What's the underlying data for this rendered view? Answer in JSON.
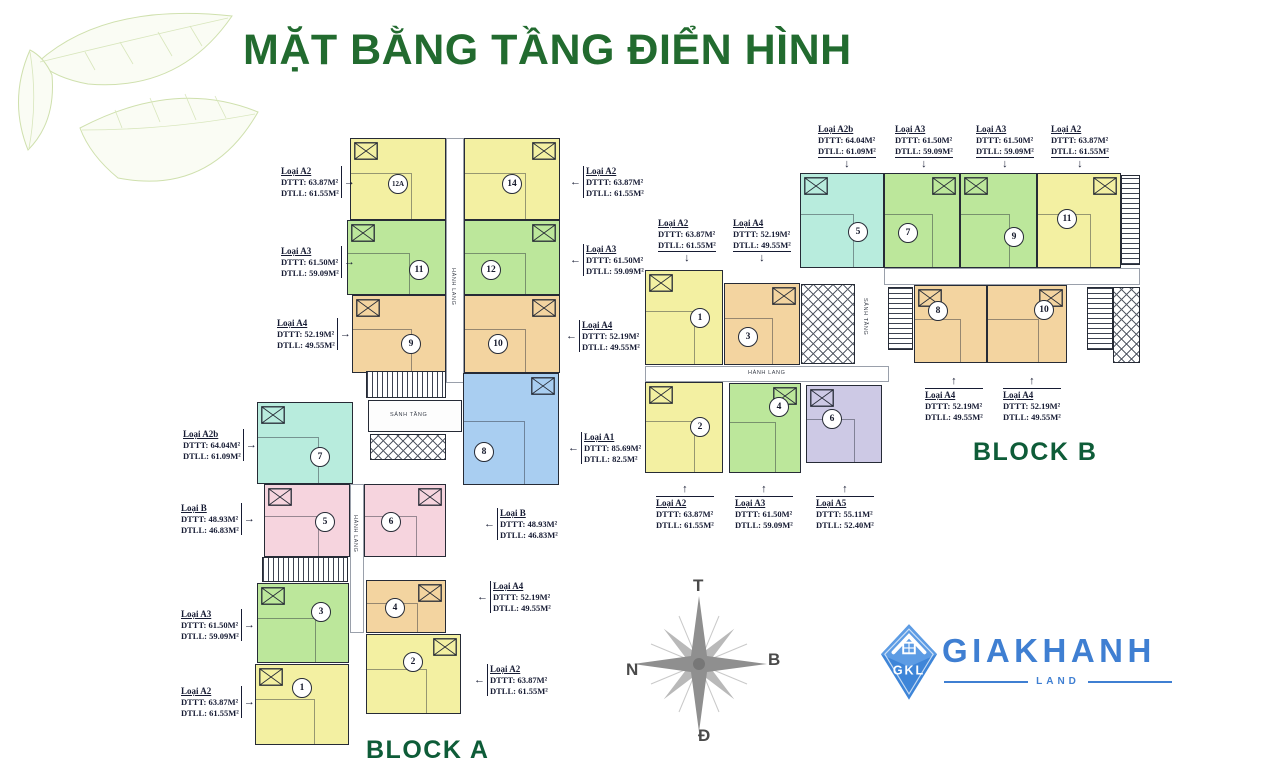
{
  "title": "MẶT BẰNG TẦNG ĐIỂN HÌNH",
  "block_a_label": "BLOCK A",
  "block_b_label": "BLOCK B",
  "compass": {
    "top": "T",
    "right": "B",
    "bottom": "Đ",
    "left": "N"
  },
  "logo": {
    "badge": "GKL",
    "brand": "GIAKHANH",
    "sub": "LAND"
  },
  "colors": {
    "title_green": "#226b2f",
    "block_green": "#0e5c38",
    "wall": "#262b36",
    "label_ink": "#161b33",
    "logo_blue": "#3f7fd2",
    "leaf_green": "#cfe0ad",
    "compass_gray": "#8f8f8f",
    "units": {
      "yellow": "#f3f0a2",
      "green": "#bce79b",
      "orange": "#f3d4a0",
      "teal": "#b8ecdd",
      "blue": "#a9cef1",
      "pink": "#f6d4de",
      "purple": "#cdc9e5"
    }
  },
  "units": [
    {
      "block": "A",
      "no": "12A",
      "color": "yellow",
      "x": 350,
      "y": 138,
      "w": 96,
      "h": 82,
      "cx": 398,
      "cy": 184
    },
    {
      "block": "A",
      "no": "14",
      "color": "yellow",
      "x": 464,
      "y": 138,
      "w": 96,
      "h": 82,
      "cx": 512,
      "cy": 184
    },
    {
      "block": "A",
      "no": "11",
      "color": "green",
      "x": 347,
      "y": 220,
      "w": 99,
      "h": 75,
      "cx": 419,
      "cy": 270
    },
    {
      "block": "A",
      "no": "12",
      "color": "green",
      "x": 464,
      "y": 220,
      "w": 96,
      "h": 75,
      "cx": 491,
      "cy": 270
    },
    {
      "block": "A",
      "no": "9",
      "color": "orange",
      "x": 352,
      "y": 295,
      "w": 94,
      "h": 78,
      "cx": 411,
      "cy": 344
    },
    {
      "block": "A",
      "no": "10",
      "color": "orange",
      "x": 464,
      "y": 295,
      "w": 96,
      "h": 78,
      "cx": 498,
      "cy": 344
    },
    {
      "block": "A",
      "no": "7",
      "color": "teal",
      "x": 257,
      "y": 402,
      "w": 96,
      "h": 82,
      "cx": 320,
      "cy": 457
    },
    {
      "block": "A",
      "no": "8",
      "color": "blue",
      "x": 463,
      "y": 373,
      "w": 96,
      "h": 112,
      "cx": 484,
      "cy": 452
    },
    {
      "block": "A",
      "no": "5",
      "color": "pink",
      "x": 264,
      "y": 484,
      "w": 86,
      "h": 73,
      "cx": 325,
      "cy": 522
    },
    {
      "block": "A",
      "no": "6",
      "color": "pink",
      "x": 364,
      "y": 484,
      "w": 82,
      "h": 73,
      "cx": 391,
      "cy": 522
    },
    {
      "block": "A",
      "no": "3",
      "color": "green",
      "x": 257,
      "y": 583,
      "w": 92,
      "h": 80,
      "cx": 321,
      "cy": 612
    },
    {
      "block": "A",
      "no": "4",
      "color": "orange",
      "x": 366,
      "y": 580,
      "w": 80,
      "h": 53,
      "cx": 395,
      "cy": 608
    },
    {
      "block": "A",
      "no": "1",
      "color": "yellow",
      "x": 255,
      "y": 664,
      "w": 94,
      "h": 81,
      "cx": 302,
      "cy": 688
    },
    {
      "block": "A",
      "no": "2",
      "color": "yellow",
      "x": 366,
      "y": 634,
      "w": 95,
      "h": 80,
      "cx": 413,
      "cy": 662
    },
    {
      "block": "B",
      "no": "5",
      "color": "teal",
      "x": 800,
      "y": 173,
      "w": 84,
      "h": 95,
      "cx": 858,
      "cy": 232
    },
    {
      "block": "B",
      "no": "7",
      "color": "green",
      "x": 884,
      "y": 173,
      "w": 76,
      "h": 95,
      "cx": 908,
      "cy": 233
    },
    {
      "block": "B",
      "no": "9",
      "color": "green",
      "x": 960,
      "y": 173,
      "w": 77,
      "h": 95,
      "cx": 1014,
      "cy": 237
    },
    {
      "block": "B",
      "no": "11",
      "color": "yellow",
      "x": 1037,
      "y": 173,
      "w": 84,
      "h": 95,
      "cx": 1067,
      "cy": 219
    },
    {
      "block": "B",
      "no": "1",
      "color": "yellow",
      "x": 645,
      "y": 270,
      "w": 78,
      "h": 95,
      "cx": 700,
      "cy": 318
    },
    {
      "block": "B",
      "no": "3",
      "color": "orange",
      "x": 724,
      "y": 283,
      "w": 76,
      "h": 82,
      "cx": 748,
      "cy": 337
    },
    {
      "block": "B",
      "no": "8",
      "color": "orange",
      "x": 914,
      "y": 285,
      "w": 73,
      "h": 78,
      "cx": 938,
      "cy": 311
    },
    {
      "block": "B",
      "no": "10",
      "color": "orange",
      "x": 987,
      "y": 285,
      "w": 80,
      "h": 78,
      "cx": 1044,
      "cy": 310
    },
    {
      "block": "B",
      "no": "2",
      "color": "yellow",
      "x": 645,
      "y": 382,
      "w": 78,
      "h": 91,
      "cx": 700,
      "cy": 427
    },
    {
      "block": "B",
      "no": "4",
      "color": "green",
      "x": 729,
      "y": 383,
      "w": 72,
      "h": 90,
      "cx": 779,
      "cy": 407
    },
    {
      "block": "B",
      "no": "6",
      "color": "purple",
      "x": 806,
      "y": 385,
      "w": 76,
      "h": 78,
      "cx": 832,
      "cy": 419
    }
  ],
  "cores": [
    {
      "kind": "corridor",
      "x": 446,
      "y": 138,
      "w": 18,
      "h": 245
    },
    {
      "kind": "corridor",
      "x": 350,
      "y": 484,
      "w": 14,
      "h": 149
    },
    {
      "kind": "stair",
      "x": 366,
      "y": 371,
      "w": 80,
      "h": 27
    },
    {
      "kind": "lobby",
      "x": 368,
      "y": 400,
      "w": 94,
      "h": 32
    },
    {
      "kind": "lift",
      "x": 370,
      "y": 434,
      "w": 76,
      "h": 26
    },
    {
      "kind": "stair",
      "x": 262,
      "y": 557,
      "w": 86,
      "h": 25
    },
    {
      "kind": "corridor",
      "x": 645,
      "y": 366,
      "w": 244,
      "h": 16
    },
    {
      "kind": "corridor",
      "x": 884,
      "y": 268,
      "w": 256,
      "h": 17
    },
    {
      "kind": "lift",
      "x": 801,
      "y": 284,
      "w": 54,
      "h": 80
    },
    {
      "kind": "stair",
      "x": 888,
      "y": 287,
      "w": 25,
      "h": 63
    },
    {
      "kind": "stair",
      "x": 1087,
      "y": 287,
      "w": 26,
      "h": 63
    },
    {
      "kind": "lift",
      "x": 1113,
      "y": 287,
      "w": 27,
      "h": 76
    },
    {
      "kind": "stair",
      "x": 1121,
      "y": 175,
      "w": 19,
      "h": 90
    }
  ],
  "corridor_labels": [
    {
      "text": "HÀNH LANG",
      "x": 450,
      "y": 268,
      "vertical": true
    },
    {
      "text": "SẢNH TẦNG",
      "x": 390,
      "y": 412,
      "vertical": false
    },
    {
      "text": "HÀNH LANG",
      "x": 352,
      "y": 515,
      "vertical": true
    },
    {
      "text": "HÀNH LANG",
      "x": 748,
      "y": 370,
      "vertical": false
    },
    {
      "text": "SẢNH TẦNG",
      "x": 862,
      "y": 298,
      "vertical": true
    }
  ],
  "area_labels": [
    {
      "loai": "Loại A2",
      "dttt": "DTTT: 63.87M²",
      "dtll": "DTLL: 61.55M²",
      "x": 281,
      "y": 166,
      "arrow": "right"
    },
    {
      "loai": "Loại A3",
      "dttt": "DTTT: 61.50M²",
      "dtll": "DTLL: 59.09M²",
      "x": 281,
      "y": 246,
      "arrow": "right"
    },
    {
      "loai": "Loại A4",
      "dttt": "DTTT: 52.19M²",
      "dtll": "DTLL: 49.55M²",
      "x": 277,
      "y": 318,
      "arrow": "right"
    },
    {
      "loai": "Loại A2b",
      "dttt": "DTTT: 64.04M²",
      "dtll": "DTLL: 61.09M²",
      "x": 183,
      "y": 429,
      "arrow": "right"
    },
    {
      "loai": "Loại B",
      "dttt": "DTTT: 48.93M²",
      "dtll": "DTLL: 46.83M²",
      "x": 181,
      "y": 503,
      "arrow": "right"
    },
    {
      "loai": "Loại A3",
      "dttt": "DTTT: 61.50M²",
      "dtll": "DTLL: 59.09M²",
      "x": 181,
      "y": 609,
      "arrow": "right"
    },
    {
      "loai": "Loại A2",
      "dttt": "DTTT: 63.87M²",
      "dtll": "DTLL: 61.55M²",
      "x": 181,
      "y": 686,
      "arrow": "right"
    },
    {
      "loai": "Loại A2",
      "dttt": "DTTT: 63.87M²",
      "dtll": "DTLL: 61.55M²",
      "x": 570,
      "y": 166,
      "arrow": "left"
    },
    {
      "loai": "Loại A3",
      "dttt": "DTTT: 61.50M²",
      "dtll": "DTLL: 59.09M²",
      "x": 570,
      "y": 244,
      "arrow": "left"
    },
    {
      "loai": "Loại A4",
      "dttt": "DTTT: 52.19M²",
      "dtll": "DTLL: 49.55M²",
      "x": 566,
      "y": 320,
      "arrow": "left"
    },
    {
      "loai": "Loại A1",
      "dttt": "DTTT: 85.69M²",
      "dtll": "DTLL: 82.5M²",
      "x": 568,
      "y": 432,
      "arrow": "left"
    },
    {
      "loai": "Loại B",
      "dttt": "DTTT: 48.93M²",
      "dtll": "DTLL: 46.83M²",
      "x": 484,
      "y": 508,
      "arrow": "left"
    },
    {
      "loai": "Loại A4",
      "dttt": "DTTT: 52.19M²",
      "dtll": "DTLL: 49.55M²",
      "x": 477,
      "y": 581,
      "arrow": "left"
    },
    {
      "loai": "Loại A2",
      "dttt": "DTTT: 63.87M²",
      "dtll": "DTLL: 61.55M²",
      "x": 474,
      "y": 664,
      "arrow": "left"
    },
    {
      "loai": "Loại A2b",
      "dttt": "DTTT: 64.04M²",
      "dtll": "DTLL: 61.09M²",
      "x": 818,
      "y": 124,
      "arrow": "down"
    },
    {
      "loai": "Loại A3",
      "dttt": "DTTT: 61.50M²",
      "dtll": "DTLL: 59.09M²",
      "x": 895,
      "y": 124,
      "arrow": "down"
    },
    {
      "loai": "Loại A3",
      "dttt": "DTTT: 61.50M²",
      "dtll": "DTLL: 59.09M²",
      "x": 976,
      "y": 124,
      "arrow": "down"
    },
    {
      "loai": "Loại A2",
      "dttt": "DTTT: 63.87M²",
      "dtll": "DTLL: 61.55M²",
      "x": 1051,
      "y": 124,
      "arrow": "down"
    },
    {
      "loai": "Loại A2",
      "dttt": "DTTT: 63.87M²",
      "dtll": "DTLL: 61.55M²",
      "x": 658,
      "y": 218,
      "arrow": "down"
    },
    {
      "loai": "Loại A4",
      "dttt": "DTTT: 52.19M²",
      "dtll": "DTLL: 49.55M²",
      "x": 733,
      "y": 218,
      "arrow": "down"
    },
    {
      "loai": "Loại A4",
      "dttt": "DTTT: 52.19M²",
      "dtll": "DTLL: 49.55M²",
      "x": 925,
      "y": 376,
      "arrow": "up"
    },
    {
      "loai": "Loại A4",
      "dttt": "DTTT: 52.19M²",
      "dtll": "DTLL: 49.55M²",
      "x": 1003,
      "y": 376,
      "arrow": "up"
    },
    {
      "loai": "Loại A2",
      "dttt": "DTTT: 63.87M²",
      "dtll": "DTLL: 61.55M²",
      "x": 656,
      "y": 484,
      "arrow": "up"
    },
    {
      "loai": "Loại A3",
      "dttt": "DTTT: 61.50M²",
      "dtll": "DTLL: 59.09M²",
      "x": 735,
      "y": 484,
      "arrow": "up"
    },
    {
      "loai": "Loại A5",
      "dttt": "DTTT: 55.11M²",
      "dtll": "DTLL: 52.40M²",
      "x": 816,
      "y": 484,
      "arrow": "up"
    }
  ]
}
